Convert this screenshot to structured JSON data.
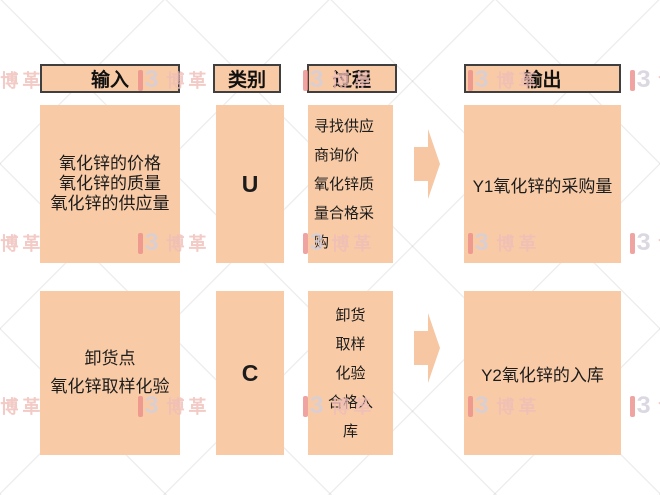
{
  "headers": {
    "input": "输入",
    "category": "类别",
    "process": "过程",
    "output": "输出"
  },
  "rows": [
    {
      "input_lines": [
        "氧化锌的价格",
        "氧化锌的质量",
        "氧化锌的供应量"
      ],
      "category": "U",
      "process_lines": [
        "寻找供应",
        "商询价",
        "氧化锌质",
        "量合格采",
        "购"
      ],
      "output": "Y1氧化锌的采购量"
    },
    {
      "input_lines": [
        "卸货点",
        "氧化锌取样化验"
      ],
      "category": "C",
      "process_lines": [
        "卸货",
        "取样",
        "化验",
        "合格入",
        "库"
      ],
      "output": "Y2氧化锌的入库"
    }
  ],
  "watermark": {
    "brand": "博革",
    "glyph": "3"
  },
  "colors": {
    "background": "#FFFFFF",
    "box_fill": "#F8CBA6",
    "header_border": "#3F3F3F",
    "text": "#1C1C1C",
    "watermark_red": "#ED8E8A",
    "watermark_glyph": "#D4CFDC",
    "watermark_pink": "#F0BEB8"
  }
}
